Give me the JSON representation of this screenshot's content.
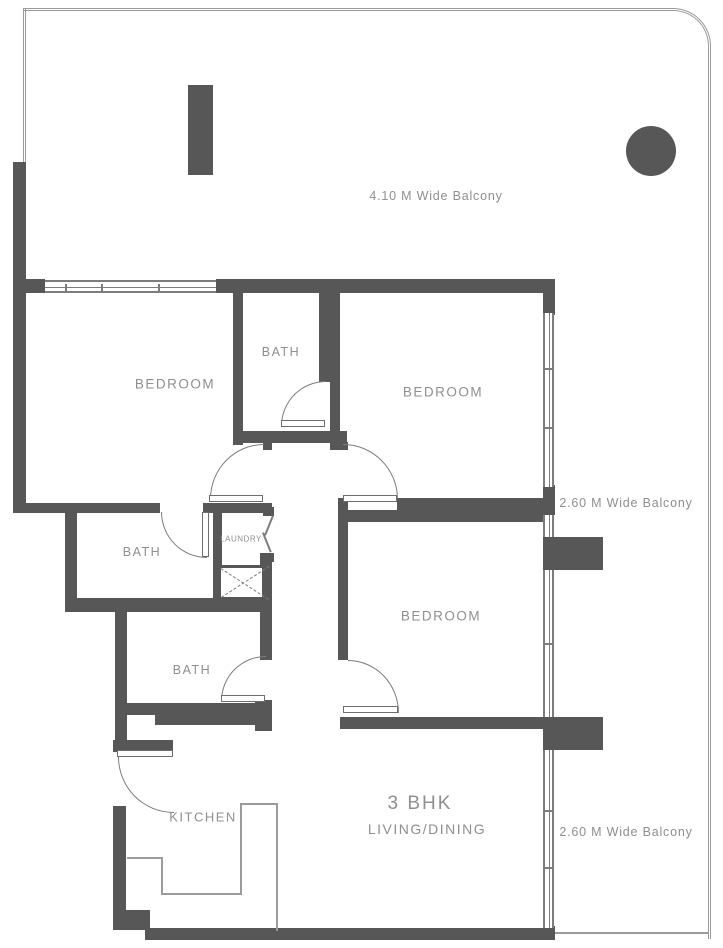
{
  "unit": {
    "type_label": "3 BHK",
    "living_dining_label": "LIVING/DINING"
  },
  "labels": {
    "bedroom_top_left": "BEDROOM",
    "bedroom_top_right": "BEDROOM",
    "bedroom_right": "BEDROOM",
    "bath_top": "BATH",
    "bath_middle": "BATH",
    "bath_lower": "BATH",
    "laundry": "LAUNDRY",
    "kitchen": "KITCHEN"
  },
  "balconies": {
    "top": "4.10 M Wide Balcony",
    "right_upper": "2.60 M Wide Balcony",
    "right_lower": "2.60 M Wide Balcony"
  },
  "colors": {
    "wall": "#575757",
    "line": "#7d7d7d",
    "outline": "#9b9b9b",
    "text": "#8f8f8f"
  }
}
